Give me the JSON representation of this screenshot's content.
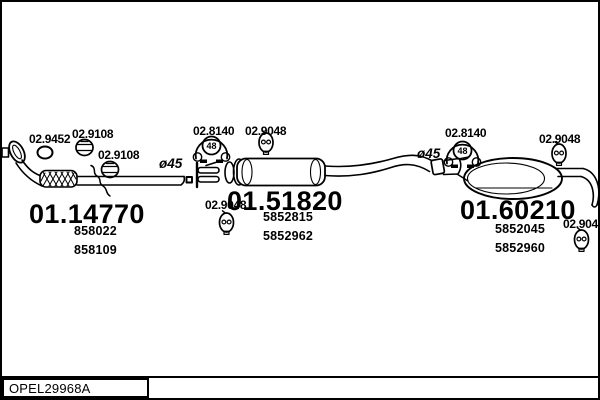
{
  "colors": {
    "ink": "#000000",
    "paper": "#ffffff"
  },
  "labels": {
    "front": {
      "gasket_code": "02.9452",
      "clamp_code_a": "02.9108",
      "clamp_code_b": "02.9108",
      "diameter": "ø45",
      "part_code": "01.14770",
      "oem_codes": [
        "858022",
        "858109"
      ]
    },
    "middle": {
      "hanger_code": "02.8140",
      "hanger_size": "48",
      "clamp_top_code": "02.9048",
      "clamp_bottom_code": "02.9048",
      "part_code": "01.51820",
      "oem_codes": [
        "5852815",
        "5852962"
      ]
    },
    "rear": {
      "diameter": "ø45",
      "hanger_code": "02.8140",
      "hanger_size": "48",
      "clamp_top_code": "02.9048",
      "clamp_bottom_code": "02.9048",
      "part_code": "01.60210",
      "oem_codes": [
        "5852045",
        "5852960"
      ]
    },
    "footer": {
      "catalog_code": "OPEL29968A"
    }
  }
}
